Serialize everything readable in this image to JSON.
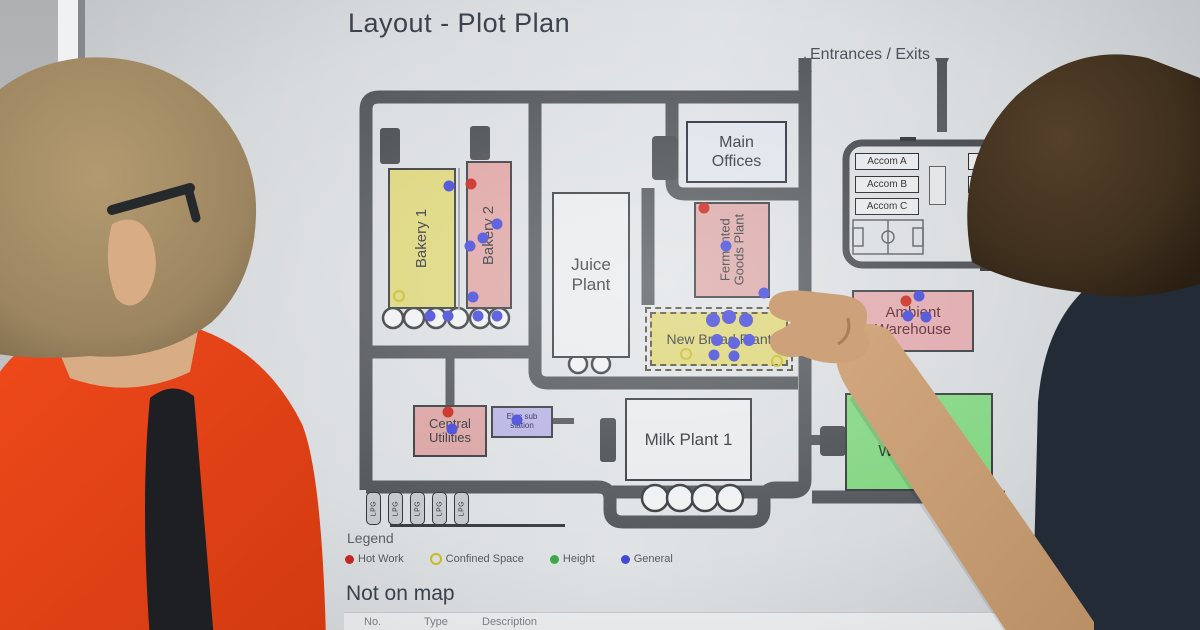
{
  "screen": {
    "title": "Layout - Plot Plan"
  },
  "map": {
    "entrances_label": "Entrances / Exits",
    "buildings": [
      {
        "id": "bakery-1",
        "label": "Bakery 1",
        "color": "#ddd67c"
      },
      {
        "id": "bakery-2",
        "label": "Bakery 2",
        "color": "#dfa5a4"
      },
      {
        "id": "juice-plant",
        "label": "Juice Plant",
        "color": "#e9ebed"
      },
      {
        "id": "main-offices",
        "label": "Main Offices",
        "color": "#dfe4ec"
      },
      {
        "id": "fermented-goods-plant",
        "label": "Fermented Goods Plant",
        "color": "#dba8a8"
      },
      {
        "id": "new-bread-plant",
        "label": "New Bread Plant",
        "color": "#ddd67a"
      },
      {
        "id": "ambient-warehouse",
        "label": "Ambient Warehouse",
        "color": "#e0a8ac"
      },
      {
        "id": "central-utilities",
        "label": "Central Utilities",
        "color": "#dba4a4"
      },
      {
        "id": "milk-plant-1",
        "label": "Milk Plant 1",
        "color": "#e9ebed"
      },
      {
        "id": "chilled-warehouse",
        "label": "Chilled Warehouse",
        "color": "#83d683"
      }
    ],
    "accom": [
      "Accom A",
      "Accom B",
      "Accom C"
    ],
    "accom_right": [
      "A",
      "A"
    ],
    "elec_sub_line1": "Elec sub",
    "elec_sub_line2": "station",
    "lpg_label": "LPG",
    "markers": [
      {
        "t": "hot",
        "x": 471,
        "y": 184
      },
      {
        "t": "hot",
        "x": 704,
        "y": 208
      },
      {
        "t": "hot",
        "x": 906,
        "y": 301
      },
      {
        "t": "hot",
        "x": 448,
        "y": 412
      },
      {
        "t": "confined",
        "x": 399,
        "y": 296
      },
      {
        "t": "confined",
        "x": 686,
        "y": 354
      },
      {
        "t": "confined",
        "x": 777,
        "y": 361
      },
      {
        "t": "height",
        "x": 912,
        "y": 432
      },
      {
        "t": "general",
        "x": 449,
        "y": 186
      },
      {
        "t": "general",
        "x": 497,
        "y": 224
      },
      {
        "t": "general",
        "x": 483,
        "y": 238
      },
      {
        "t": "general",
        "x": 470,
        "y": 246
      },
      {
        "t": "general",
        "x": 473,
        "y": 297
      },
      {
        "t": "general",
        "x": 430,
        "y": 316
      },
      {
        "t": "general",
        "x": 448,
        "y": 316
      },
      {
        "t": "general",
        "x": 478,
        "y": 316
      },
      {
        "t": "general",
        "x": 497,
        "y": 316
      },
      {
        "t": "general",
        "x": 726,
        "y": 246
      },
      {
        "t": "general",
        "x": 764,
        "y": 293
      },
      {
        "t": "general",
        "x": 713,
        "y": 320,
        "r": 7
      },
      {
        "t": "general",
        "x": 729,
        "y": 317,
        "r": 7
      },
      {
        "t": "general",
        "x": 746,
        "y": 320,
        "r": 7
      },
      {
        "t": "general",
        "x": 717,
        "y": 340,
        "r": 6
      },
      {
        "t": "general",
        "x": 734,
        "y": 343,
        "r": 6
      },
      {
        "t": "general",
        "x": 749,
        "y": 340,
        "r": 6
      },
      {
        "t": "general",
        "x": 714,
        "y": 355
      },
      {
        "t": "general",
        "x": 734,
        "y": 356
      },
      {
        "t": "general",
        "x": 919,
        "y": 296
      },
      {
        "t": "general",
        "x": 926,
        "y": 317
      },
      {
        "t": "general",
        "x": 908,
        "y": 316
      },
      {
        "t": "general",
        "x": 517,
        "y": 420
      },
      {
        "t": "general",
        "x": 452,
        "y": 429
      }
    ]
  },
  "legend": {
    "title": "Legend",
    "items": [
      {
        "label": "Hot Work",
        "color": "#c8281e"
      },
      {
        "label": "Confined Space",
        "color": "#c9bd2a"
      },
      {
        "label": "Height",
        "color": "#3da84a"
      },
      {
        "label": "General",
        "color": "#4348d8"
      }
    ]
  },
  "not_on_map": {
    "title": "Not on map",
    "columns": [
      "No.",
      "Type",
      "Description"
    ]
  }
}
